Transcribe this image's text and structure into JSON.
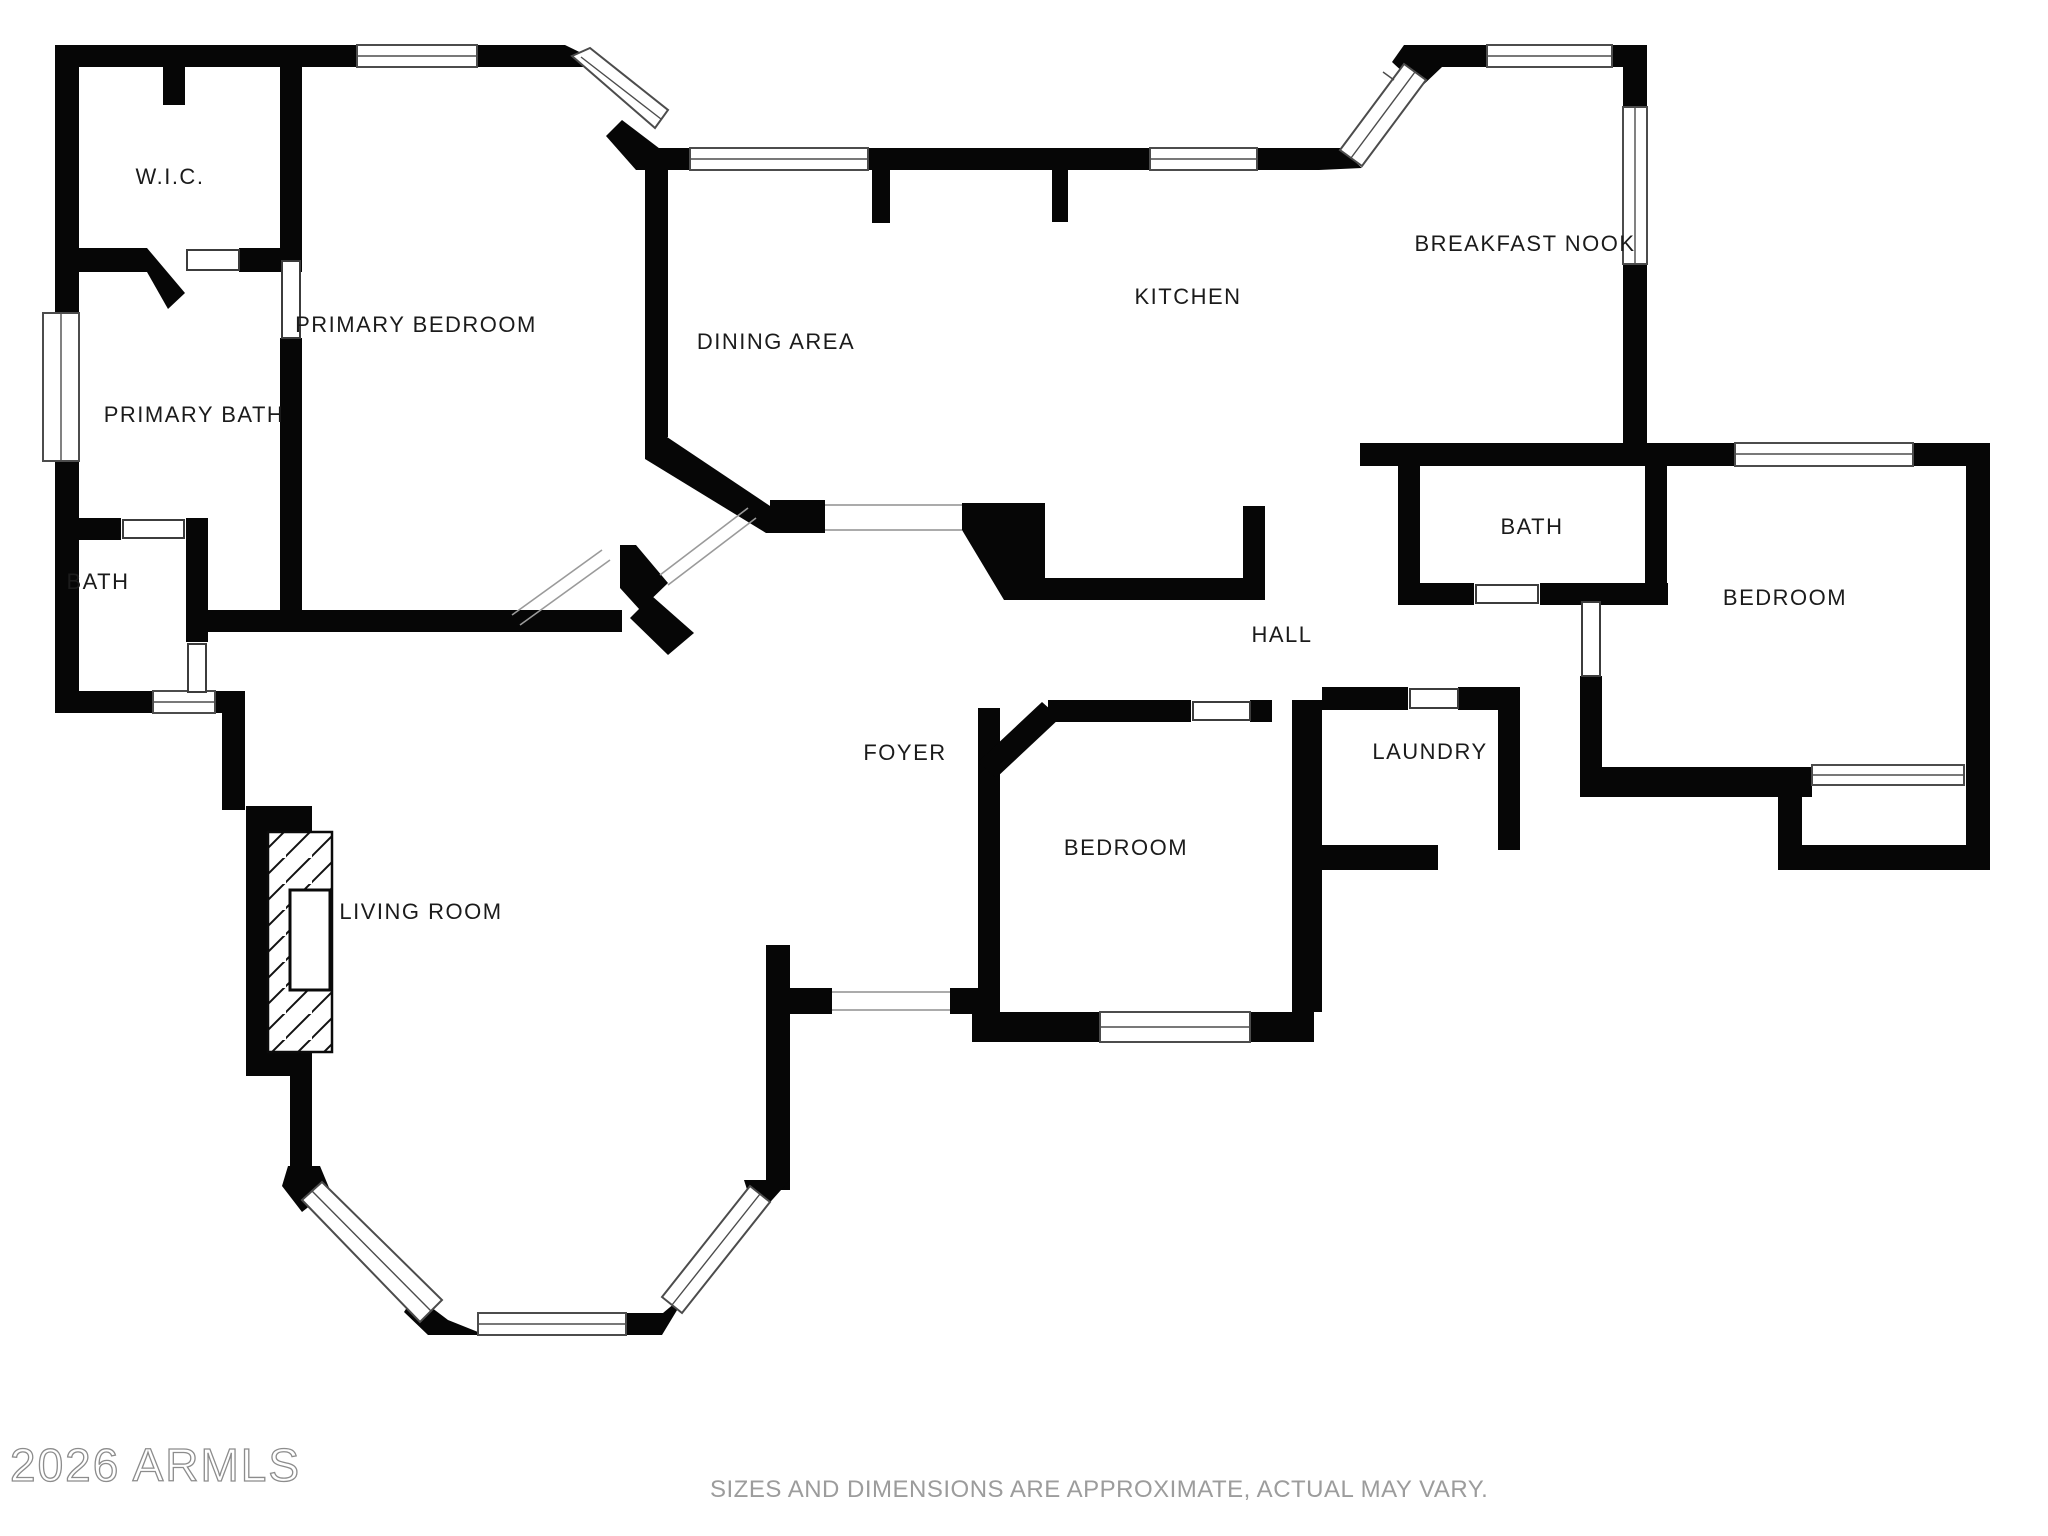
{
  "colors": {
    "wall": "#060606",
    "background": "#ffffff",
    "label_text": "#1b1b1b",
    "watermark": "#8c8c8c",
    "disclaimer": "#9c9c9c"
  },
  "rooms": {
    "wic": {
      "label": "W.I.C."
    },
    "primary_bedroom": {
      "label": "PRIMARY BEDROOM"
    },
    "primary_bath": {
      "label": "PRIMARY BATH"
    },
    "bath_left": {
      "label": "BATH"
    },
    "dining_area": {
      "label": "DINING AREA"
    },
    "kitchen": {
      "label": "KITCHEN"
    },
    "breakfast_nook": {
      "label": "BREAKFAST NOOK"
    },
    "bath_right": {
      "label": "BATH"
    },
    "bedroom_right": {
      "label": "BEDROOM"
    },
    "hall": {
      "label": "HALL"
    },
    "laundry": {
      "label": "LAUNDRY"
    },
    "bedroom_center": {
      "label": "BEDROOM"
    },
    "foyer": {
      "label": "FOYER"
    },
    "living_room": {
      "label": "LIVING ROOM"
    }
  },
  "watermark": {
    "text": "2026 ARMLS"
  },
  "disclaimer": {
    "text": "SIZES AND DIMENSIONS ARE APPROXIMATE, ACTUAL MAY VARY."
  }
}
